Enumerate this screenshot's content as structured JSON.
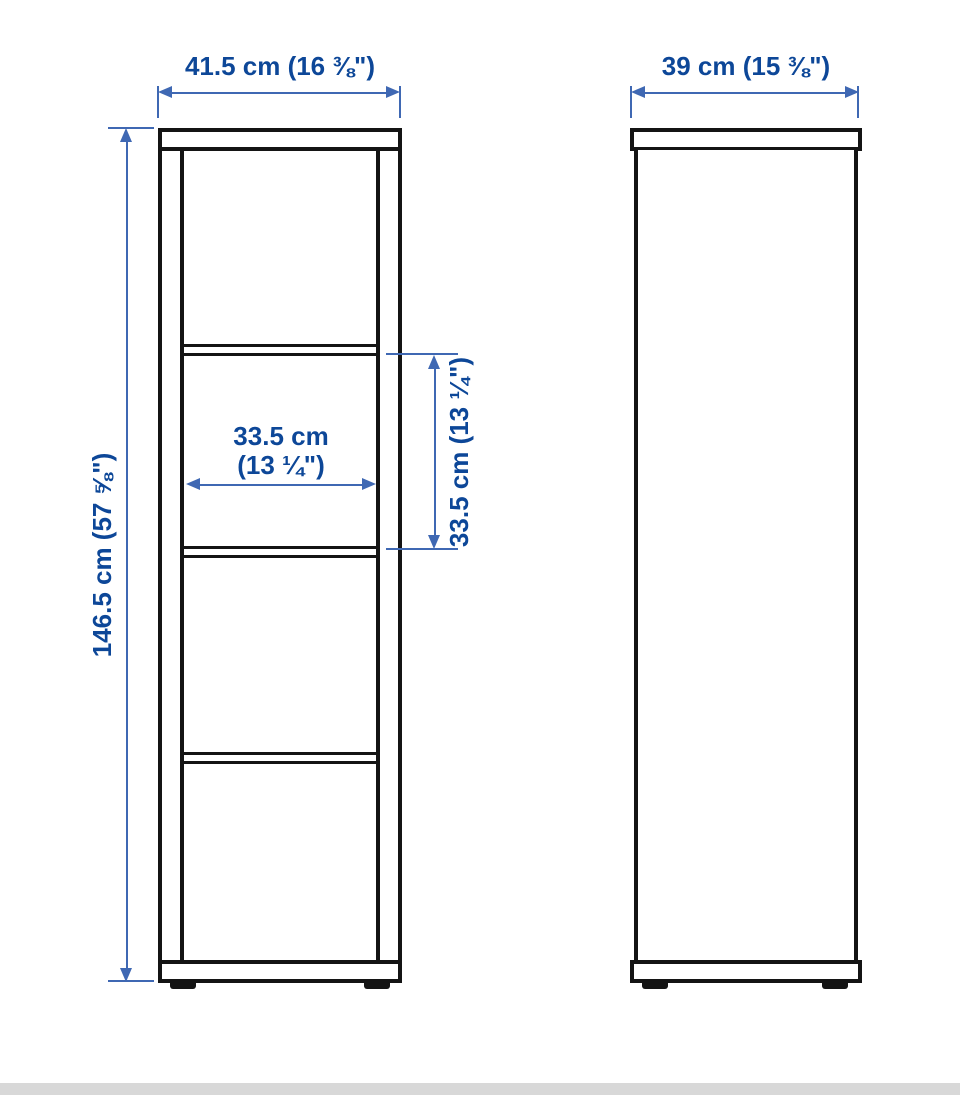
{
  "diagram_title": "shelf-unit-dimension-diagram",
  "colors": {
    "blue": "#0d4798",
    "arrow": "#3f68b3",
    "black": "#141414",
    "graybar": "#d8d8d8"
  },
  "front_view": {
    "width_label": "41.5 cm (16 ⅜\")",
    "height_label": "146.5 cm (57 ⅝\")",
    "inner_width_label_line1": "33.5 cm",
    "inner_width_label_line2": "(13 ¼\")",
    "inner_height_label": "33.5 cm (13 ¼\")",
    "compartment_count": 4
  },
  "side_view": {
    "depth_label": "39 cm (15 ⅜\")"
  }
}
